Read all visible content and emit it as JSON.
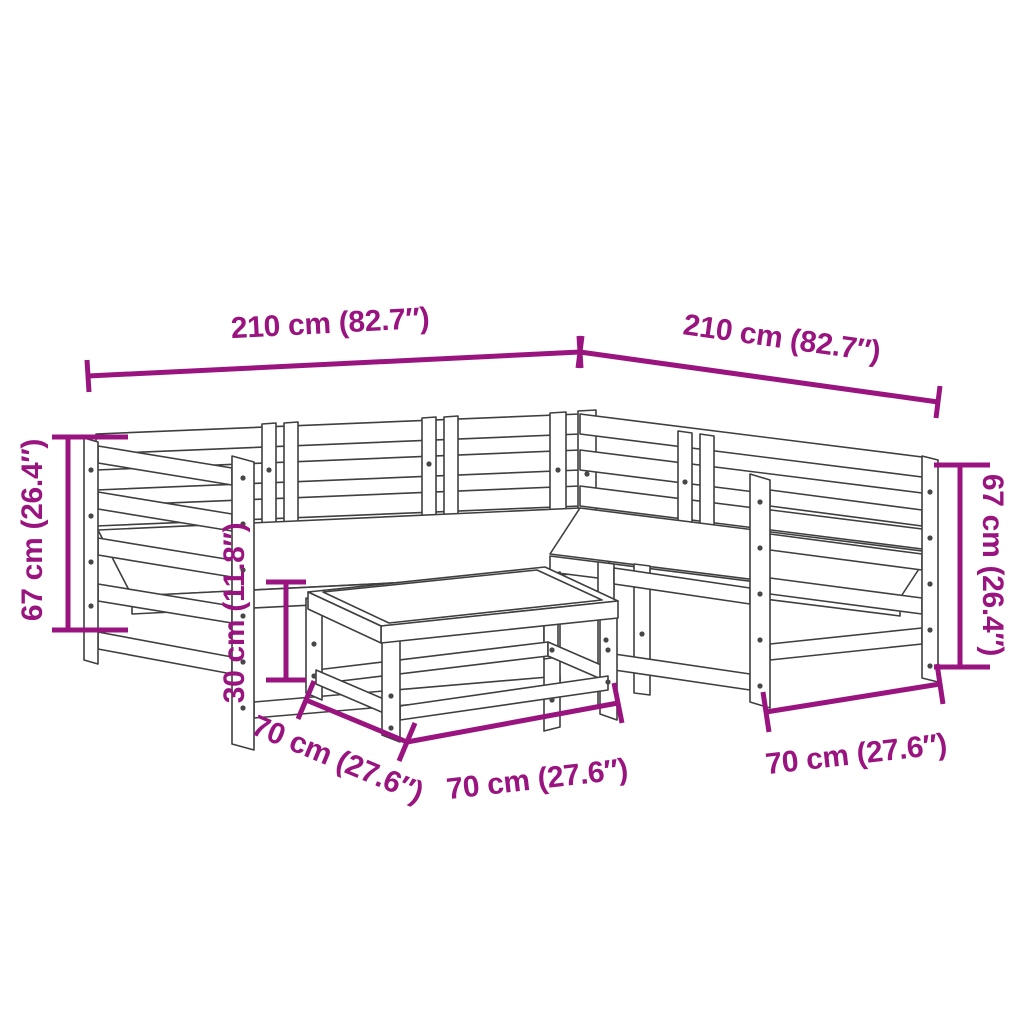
{
  "colors": {
    "accent": "#9a1480",
    "line": "#3f3f3f",
    "screw": "#474747",
    "background": "#ffffff"
  },
  "dimension_labels": {
    "top_left": "210 cm (82.7″)",
    "top_right": "210 cm (82.7″)",
    "left_side": "67 cm (26.4″)",
    "right_side": "67 cm (26.4″)",
    "stool_height": "30 cm (11.8″)",
    "stool_depth_left": "70 cm (27.6″)",
    "stool_depth_front": "70 cm (27.6″)",
    "sofa_depth_right": "70 cm (27.6″)"
  }
}
